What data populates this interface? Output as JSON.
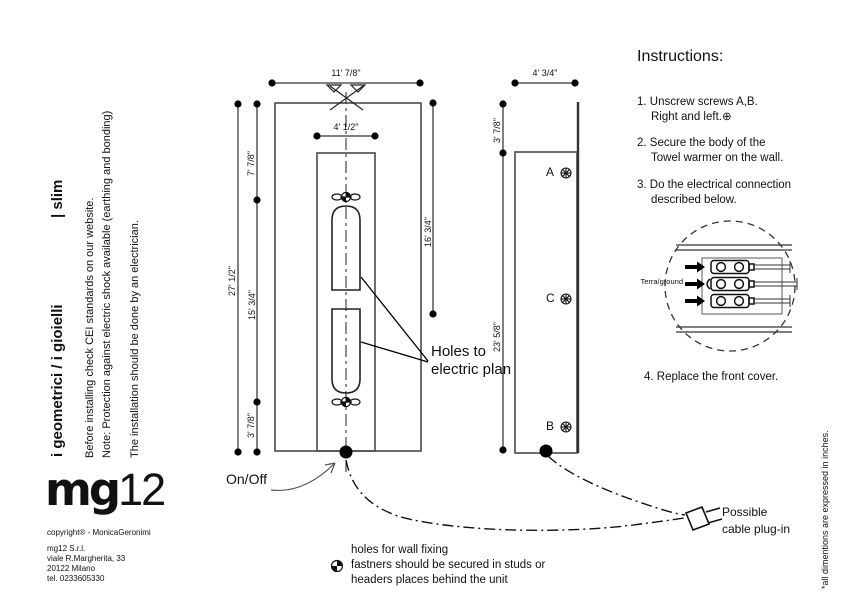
{
  "page": {
    "side_note": "*all dimentions are expressed in inches."
  },
  "brand": {
    "series": "i geometrici / i  gioielli",
    "model": "| slim",
    "note1": "Before installing check CEI standards on our website.",
    "note2": "Note: Protection against electric shock available (earthing and bonding)",
    "note3": "The installation should be done by an electrician.",
    "logo_mg": "mg",
    "logo_12": "12",
    "copyright": "copyright® - MonicaGeronimi",
    "address1": "mg12 S.r.l.",
    "address2": "viale R.Margherita, 33",
    "address3": "20122 Milano",
    "address4": "tel. 0233605330"
  },
  "front_view": {
    "dim_width": "11' 7/8\"",
    "dim_inner_width": "4' 1/2\"",
    "dim_height": "27' 1/2\"",
    "dim_top": "7' 7/8\"",
    "dim_mid": "15' 3/4\"",
    "dim_bottom": "3' 7/8\"",
    "dim_right": "16' 3/4\"",
    "onoff_label": "On/Off",
    "holes_line1": "Holes to",
    "holes_line2": "electric plan"
  },
  "side_view": {
    "dim_width": "4' 3/4\"",
    "dim_top": "3' 7/8\"",
    "dim_body": "23' 5/8\"",
    "screw_a": "A",
    "screw_c": "C",
    "screw_b": "B"
  },
  "instructions": {
    "heading": "Instructions:",
    "step1a": "1. Unscrew screws A,B.",
    "step1b": "Right and left.⊕",
    "step2a": "2. Secure the body of the",
    "step2b": "Towel warmer on the wall.",
    "step3a": "3. Do the electrical connection",
    "step3b": "described below.",
    "step4": "4. Replace the front cover.",
    "terra_label": "Terra/ground"
  },
  "annotations": {
    "cable_line1": "Possible",
    "cable_line2": "cable plug-in",
    "fixing_line1": "holes for wall fixing",
    "fixing_line2": "fastners should be secured in studs or",
    "fixing_line3": "headers places behind the unit"
  }
}
